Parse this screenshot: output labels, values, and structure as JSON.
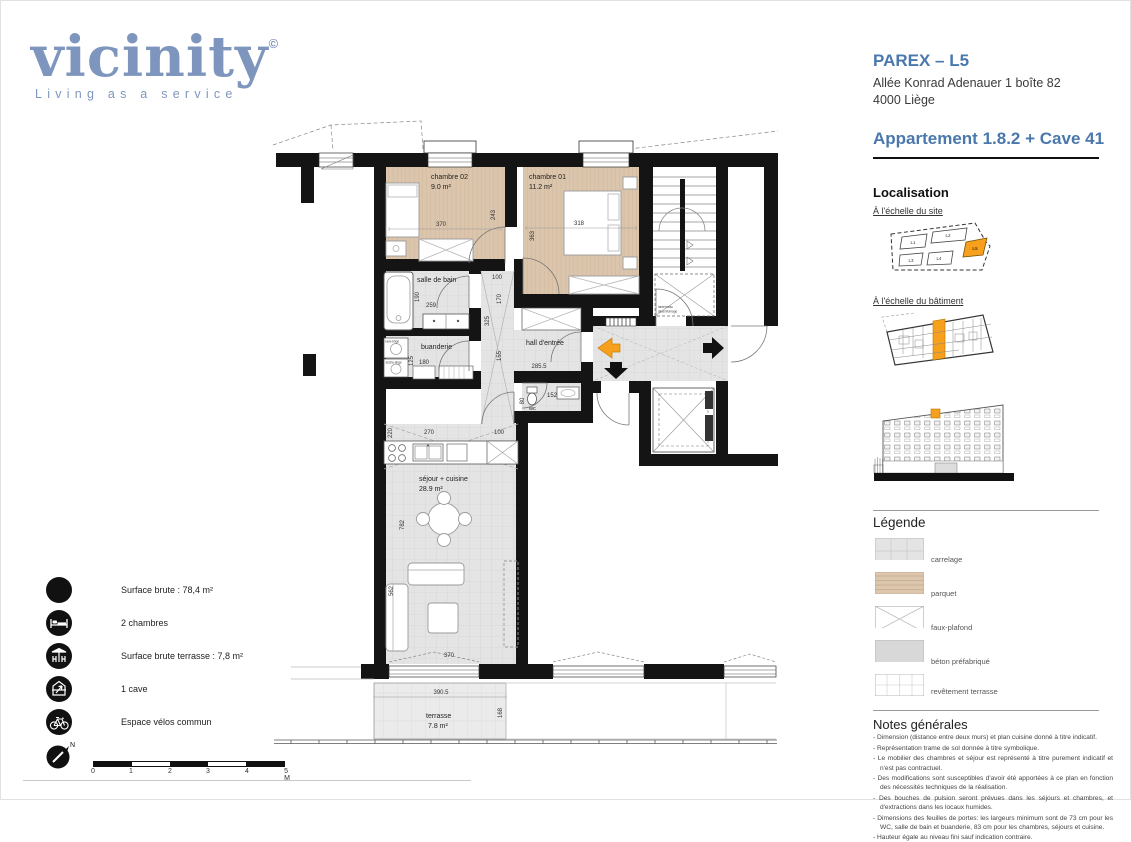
{
  "logo": {
    "name": "vicinity",
    "registered": "©",
    "tagline": "Living as a service"
  },
  "header": {
    "project": "PAREX – L5",
    "address_line1": "Allée Konrad Adenauer 1 boîte 82",
    "address_line2": "4000  Liège",
    "apartment": "Appartement 1.8.2 + Cave 41"
  },
  "localisation": {
    "title": "Localisation",
    "site_label": "À l'échelle du site",
    "building_label": "À l'échelle du bâtiment",
    "site_buildings": [
      "L1",
      "L2",
      "L3",
      "L4",
      "L5"
    ]
  },
  "legend": {
    "title": "Légende",
    "items": [
      {
        "label": "carrelage"
      },
      {
        "label": "parquet"
      },
      {
        "label": "faux-plafond"
      },
      {
        "label": "béton préfabriqué"
      },
      {
        "label": "revêtement terrasse"
      }
    ]
  },
  "notes": {
    "title": "Notes générales",
    "items": [
      "Dimension (distance entre deux murs) et plan cuisine donné à titre indicatif.",
      "Représentation trame de sol donnée à titre symbolique.",
      "Le mobilier des chambres et séjour est représenté à titre purement indicatif et n'est pas contractuel.",
      "Des modifications sont susceptibles d'avoir été apportées à ce plan en fonction des nécessités techniques de la réalisation.",
      "Des bouches de pulsion seront prévues dans les séjours et chambres, et d'extractions dans les locaux humides.",
      "Dimensions des feuilles de portes: les largeurs minimum sont de 73 cm pour les WC, salle de bain et buanderie, 83 cm pour les chambres, séjours et cuisine.",
      "Hauteur égale au niveau fini sauf indication contraire."
    ]
  },
  "facts": {
    "items": [
      {
        "icon": "surface-icon",
        "label": "Surface brute : 78,4 m²"
      },
      {
        "icon": "bed-icon",
        "label": "2 chambres"
      },
      {
        "icon": "terrace-icon",
        "label": "Surface brute terrasse : 7,8 m²"
      },
      {
        "icon": "cave-icon",
        "label": "1 cave"
      },
      {
        "icon": "bike-icon",
        "label": "Espace vélos commun"
      }
    ]
  },
  "compass": {
    "north": "N"
  },
  "scalebar": {
    "labels": [
      "0",
      "1",
      "2",
      "3",
      "4",
      "5 M"
    ]
  },
  "plan": {
    "rooms": {
      "ch02_name": "chambre 02",
      "ch02_area": "9.0 m²",
      "ch01_name": "chambre 01",
      "ch01_area": "11.2 m²",
      "sdb_name": "salle de bain",
      "bua_name": "buanderie",
      "hall_name": "hall d'entrée",
      "wc_name": "wc",
      "sej_name": "séjour + cuisine",
      "sej_area": "28.9 m²",
      "ter_name": "terrasse",
      "ter_area": "7.8 m²"
    },
    "dims": {
      "ch02_w": "370",
      "ch02_h": "243",
      "ch01_w": "318",
      "ch01_h": "363",
      "sdb_w": "259",
      "sdb_h": "190",
      "bua_w": "180",
      "bua_h": "125",
      "strip_top": "100",
      "strip_a": "170",
      "strip_b": "325",
      "strip_c": "155",
      "hall_w": "285.5",
      "wc_h": "80",
      "wc_w": "152",
      "kit_a": "220",
      "kit_b": "270",
      "kit_c": "100",
      "sej_a": "782",
      "sej_b": "562",
      "sej_w": "370",
      "ter_w": "390.5",
      "ter_h": "168"
    },
    "appliances": {
      "lave_linge": "lave-linge",
      "seche_linge": "sèche-linge"
    },
    "stair_note1": "lanterneau",
    "stair_note2": "désenfumage"
  },
  "colors": {
    "accent_orange": "#F6A01D",
    "brand_blue": "#7E96BD",
    "heading_blue": "#4A78AD"
  }
}
